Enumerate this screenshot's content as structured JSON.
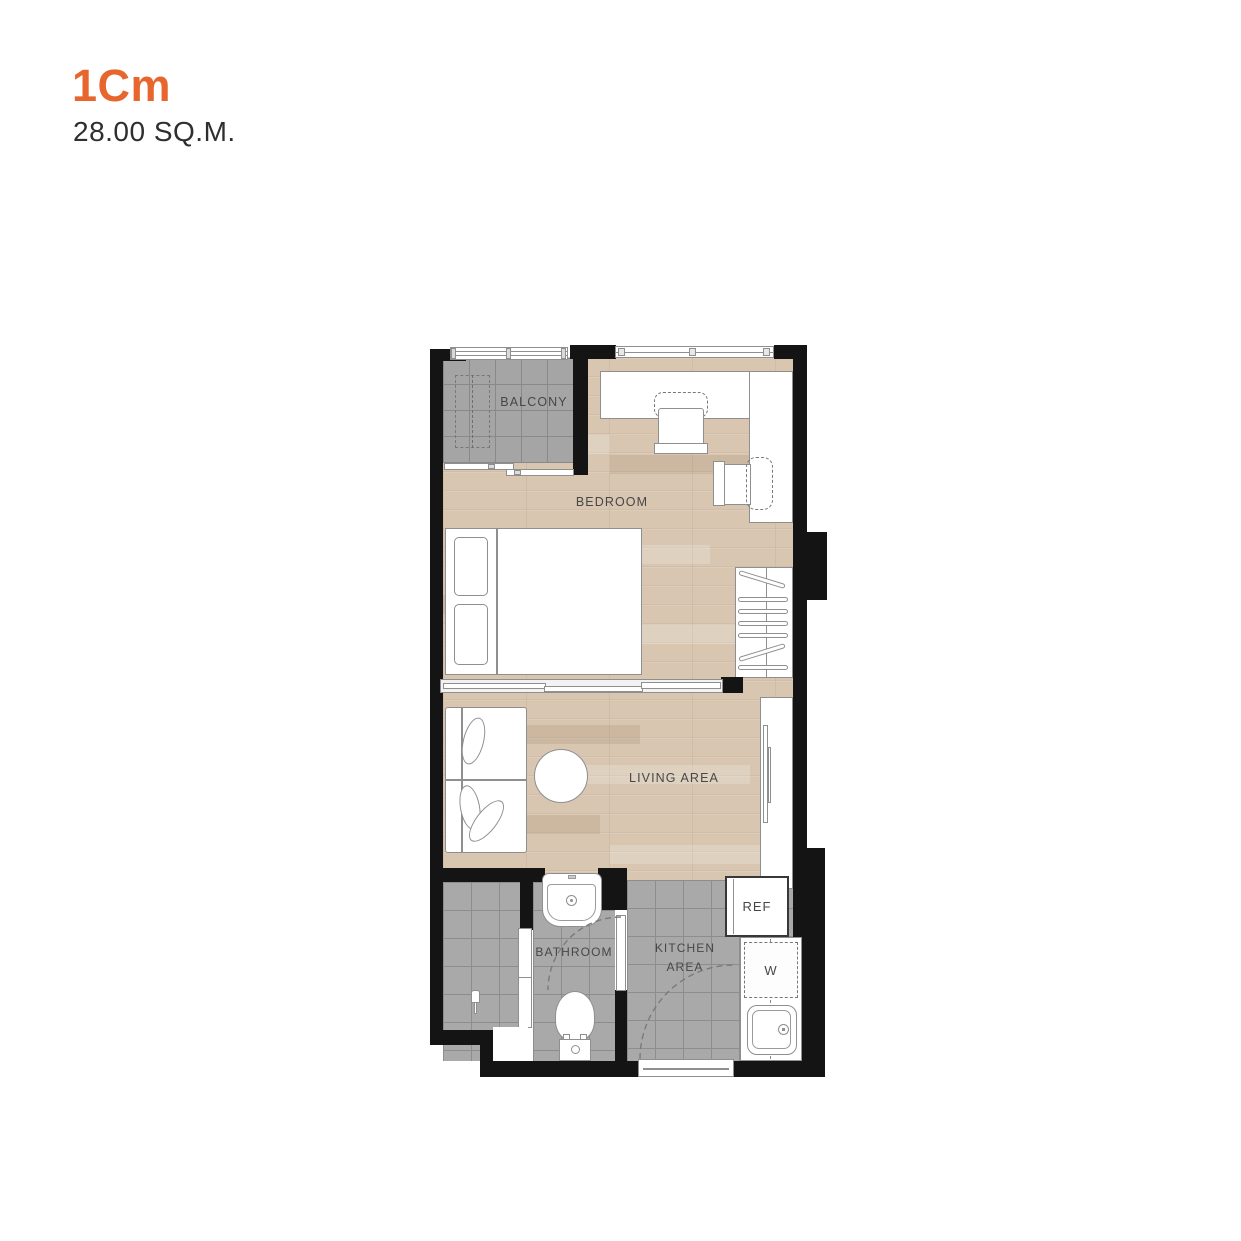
{
  "header": {
    "title": "1Cm",
    "area": "28.00 SQ.M."
  },
  "floorplan": {
    "rooms": {
      "balcony": "BALCONY",
      "bedroom": "BEDROOM",
      "living": "LIVING AREA",
      "bathroom": "BATHROOM",
      "kitchen1": "KITCHEN",
      "kitchen2": "AREA"
    },
    "appliances": {
      "refrigerator": "REF",
      "washer": "W"
    },
    "colors": {
      "accent": "#E6662E",
      "wall": "#141414",
      "wood": "#D8C6B1",
      "tile": "#A9A9A9",
      "label": "#474747"
    }
  }
}
